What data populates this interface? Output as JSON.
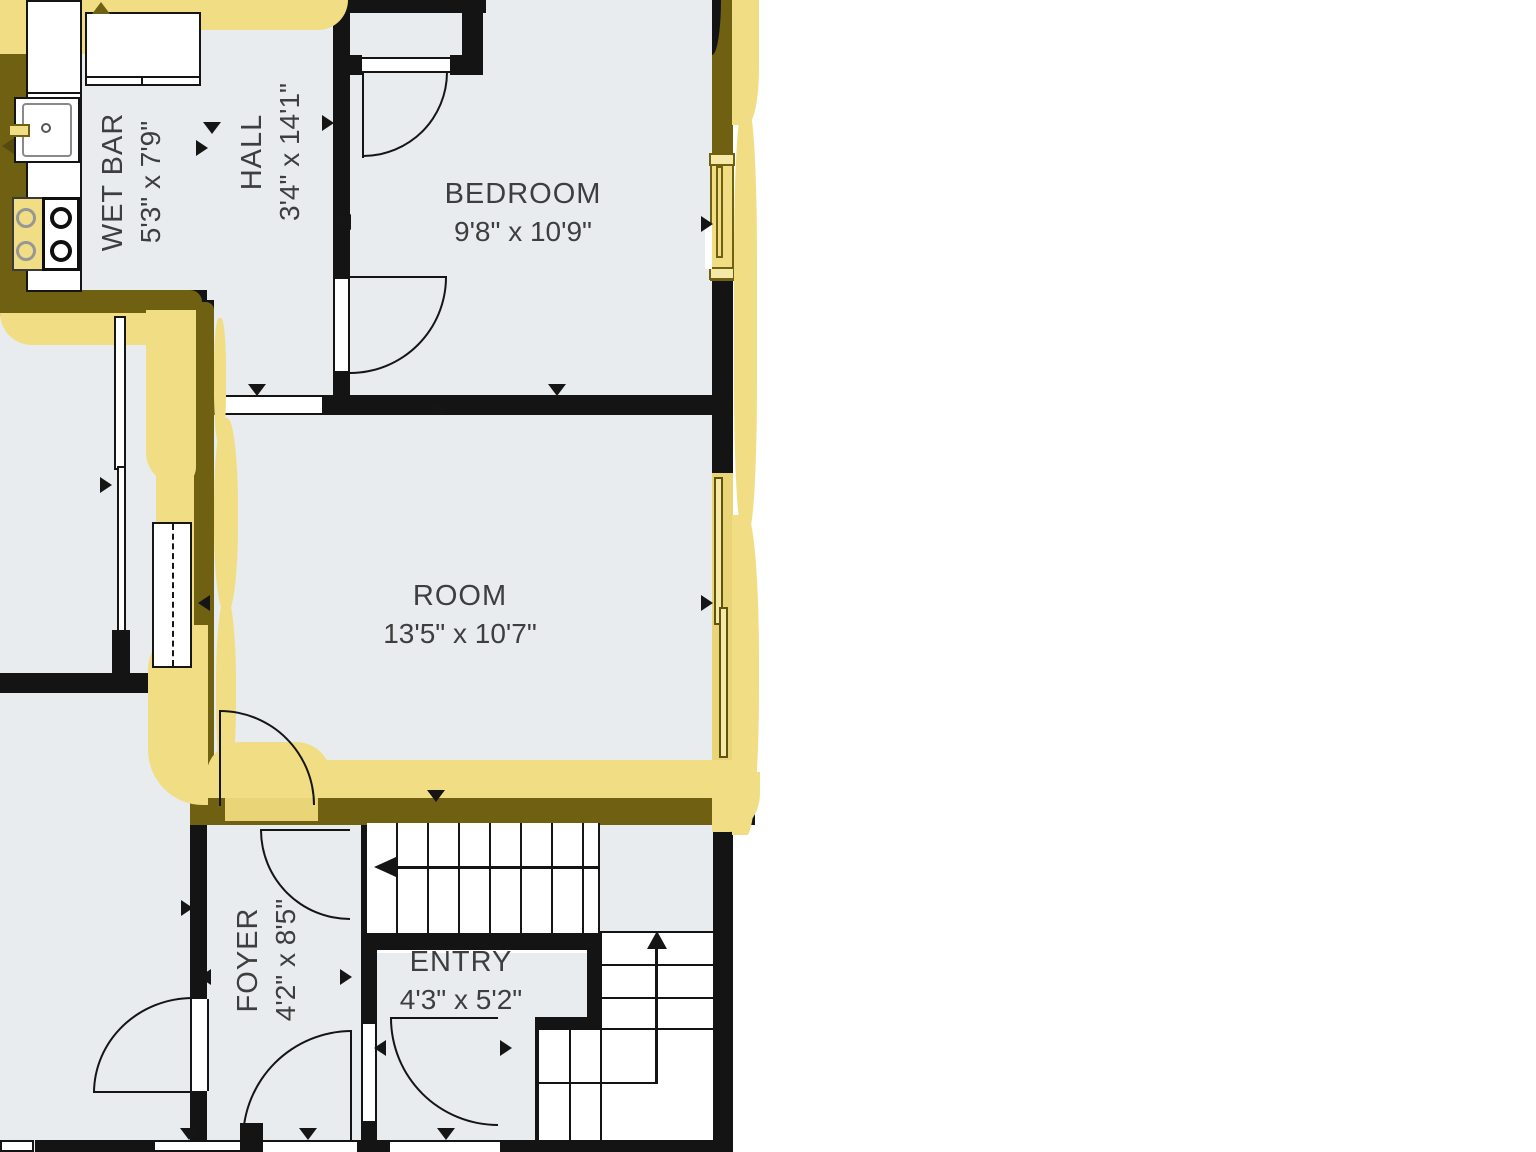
{
  "title": "Floor plan with highlighted unit outline",
  "colors": {
    "floor": "#e8ecef",
    "wall": "#141414",
    "label": "#3e3e3e",
    "hl": "#f1de84",
    "hdark": "#6f6012",
    "hmid": "#e9d478",
    "window_fill": "#f6e9a8"
  },
  "rooms": {
    "wet_bar": {
      "name": "WET BAR",
      "dims": "5'3\" x 7'9\""
    },
    "hall": {
      "name": "HALL",
      "dims": "3'4\" x 14'1\""
    },
    "bedroom": {
      "name": "BEDROOM",
      "dims": "9'8\" x 10'9\""
    },
    "room": {
      "name": "ROOM",
      "dims": "13'5\" x 10'7\""
    },
    "foyer": {
      "name": "FOYER",
      "dims": "4'2\" x 8'5\""
    },
    "entry": {
      "name": "ENTRY",
      "dims": "4'3\" x 5'2\""
    }
  },
  "annotations": {
    "highlight": "yellow marker outline around upper unit walls",
    "stairs_upper_arrow": "left",
    "stairs_lower_arrow": "up"
  }
}
